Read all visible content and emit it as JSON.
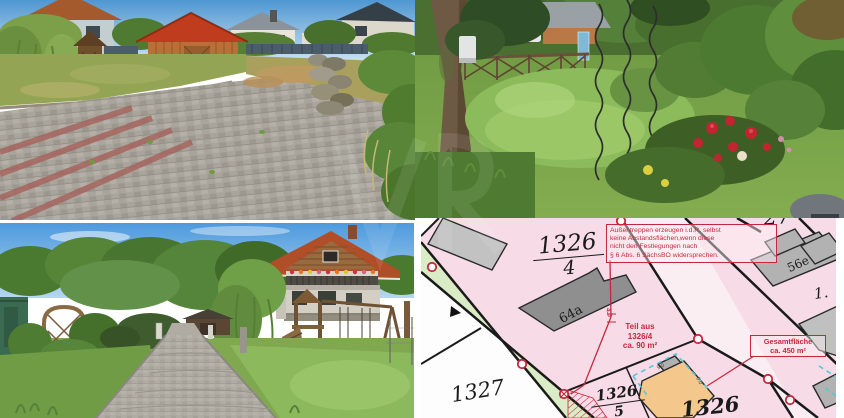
{
  "map": {
    "parcels": {
      "p1326_4_num": "1326",
      "p1326_4_den": "4",
      "p1327": "1327",
      "p1326_5_num": "1326",
      "p1326_5_den": "5",
      "p1326": "1326",
      "p27": "27",
      "p1_cut": "1."
    },
    "houses": {
      "h64a": "64a",
      "h56e": "56e"
    },
    "notes": {
      "abstand_l1": "Außentreppen erzeugen i.d.R. selbst",
      "abstand_l2": "keine Abstandsflächen,wenn diese",
      "abstand_l3": "nicht den Festlegungen nach",
      "abstand_l4": "§ 6 Abs. 6 SächsBO widersprechen.",
      "teil_l1": "Teil aus",
      "teil_l2": "1326/4",
      "teil_l3": "ca. 90 m²",
      "gesamt_l1": "Gesamtfläche",
      "gesamt_l2": "ca. 450 m²"
    },
    "dimensions": {
      "d40": "4.0",
      "d90a": "9.0",
      "d90b": "9.0"
    },
    "colors": {
      "parcel_pink": "#f7dce7",
      "path_green": "#daecc6",
      "annotation_red": "#c5283d",
      "building_gray": "#8f8f8f",
      "building_light_gray": "#b9b9b9",
      "planned_building_orange": "#f4c78c",
      "offset_dashed_cyan": "#55c8da"
    }
  }
}
